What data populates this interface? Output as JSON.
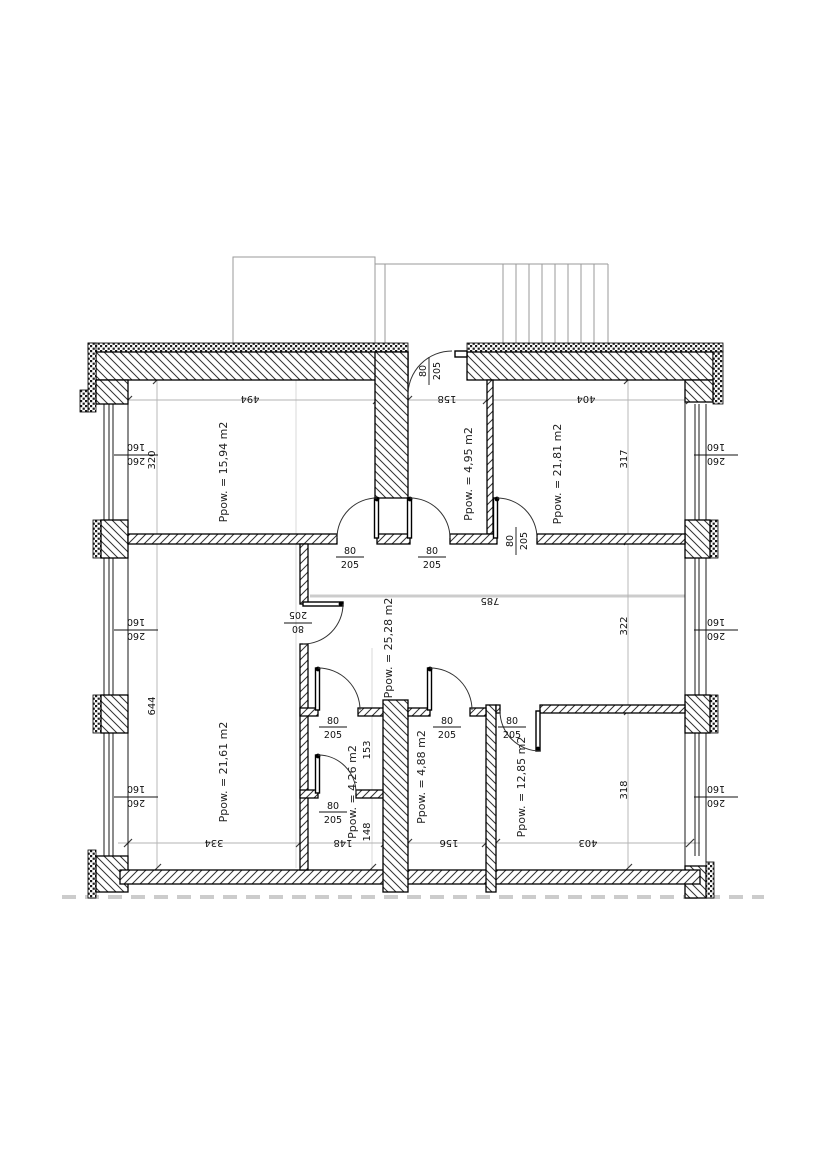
{
  "drawing": {
    "kind_label": "apartment floor plan",
    "rooms": [
      {
        "id": "room-top-left",
        "area_label": "Ppow. = 15,94 m2"
      },
      {
        "id": "hall-top-middle",
        "area_label": "Ppow. = 4,95 m2"
      },
      {
        "id": "room-top-right",
        "area_label": "Ppow. = 21,81 m2"
      },
      {
        "id": "room-bottom-left",
        "area_label": "Ppow. = 21,61 m2"
      },
      {
        "id": "corridor-middle",
        "area_label": "Ppow. = 25,28 m2"
      },
      {
        "id": "wc-middle",
        "area_label": "Ppow. = 4,26 m2"
      },
      {
        "id": "bathroom-middle",
        "area_label": "Ppow. = 4,88 m2"
      },
      {
        "id": "room-bottom-right",
        "area_label": "Ppow. = 12,85 m2"
      }
    ],
    "dimensions": {
      "top": [
        "494",
        "158",
        "404"
      ],
      "bottom": [
        "334",
        "148",
        "156",
        "403"
      ],
      "left": [
        "320",
        "644"
      ],
      "right": [
        "317",
        "322",
        "318"
      ],
      "middle": [
        "785"
      ],
      "wc_column": [
        "153",
        "148"
      ]
    },
    "door_label": {
      "width": "80",
      "height": "205"
    },
    "window_label": {
      "width": "260",
      "height": "160"
    },
    "colors": {
      "background": "#ffffff",
      "wall_outline": "#000000",
      "hatch": "#333333",
      "dimension_line": "#b3b3b3",
      "roof_outline": "#9a9a9a",
      "ground_dash": "#cccccc"
    }
  }
}
